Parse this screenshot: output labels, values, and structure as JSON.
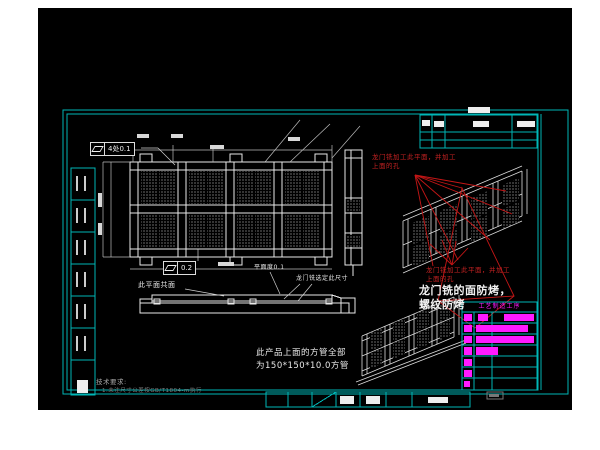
{
  "colors": {
    "frame_cyan": "#00b6b6",
    "line_white": "#e8e8e8",
    "annotation_red": "#c62222",
    "highlight_magenta": "#ff1aff",
    "canvas_black": "#000000"
  },
  "sheet": {
    "process_table_title": "工艺制造工序"
  },
  "annotations": {
    "gdt_top_value": "4处0.1",
    "gdt_front_value": "0.2",
    "coplanar": "此平面共面",
    "flatness": "平面度0.1",
    "gantry_size": "龙门铣选定此尺寸",
    "tube_note_l1": "此产品上面的方管全部",
    "tube_note_l2": "为150*150*10.0方管",
    "tech_title": "技术要求:",
    "tech_item": "1.未注尺寸公差按GB/T1804-m执行",
    "red_top_l1": "龙门铣加工此平面，并加工",
    "red_top_l2": "上面的孔",
    "red_mid_l1": "龙门铣加工此平面，并加工",
    "red_mid_l2": "上面的孔",
    "bake_l1": "龙门铣的面防烤，",
    "bake_l2": "螺纹防烤"
  },
  "icons": {
    "flatness_symbol": "parallelogram"
  }
}
